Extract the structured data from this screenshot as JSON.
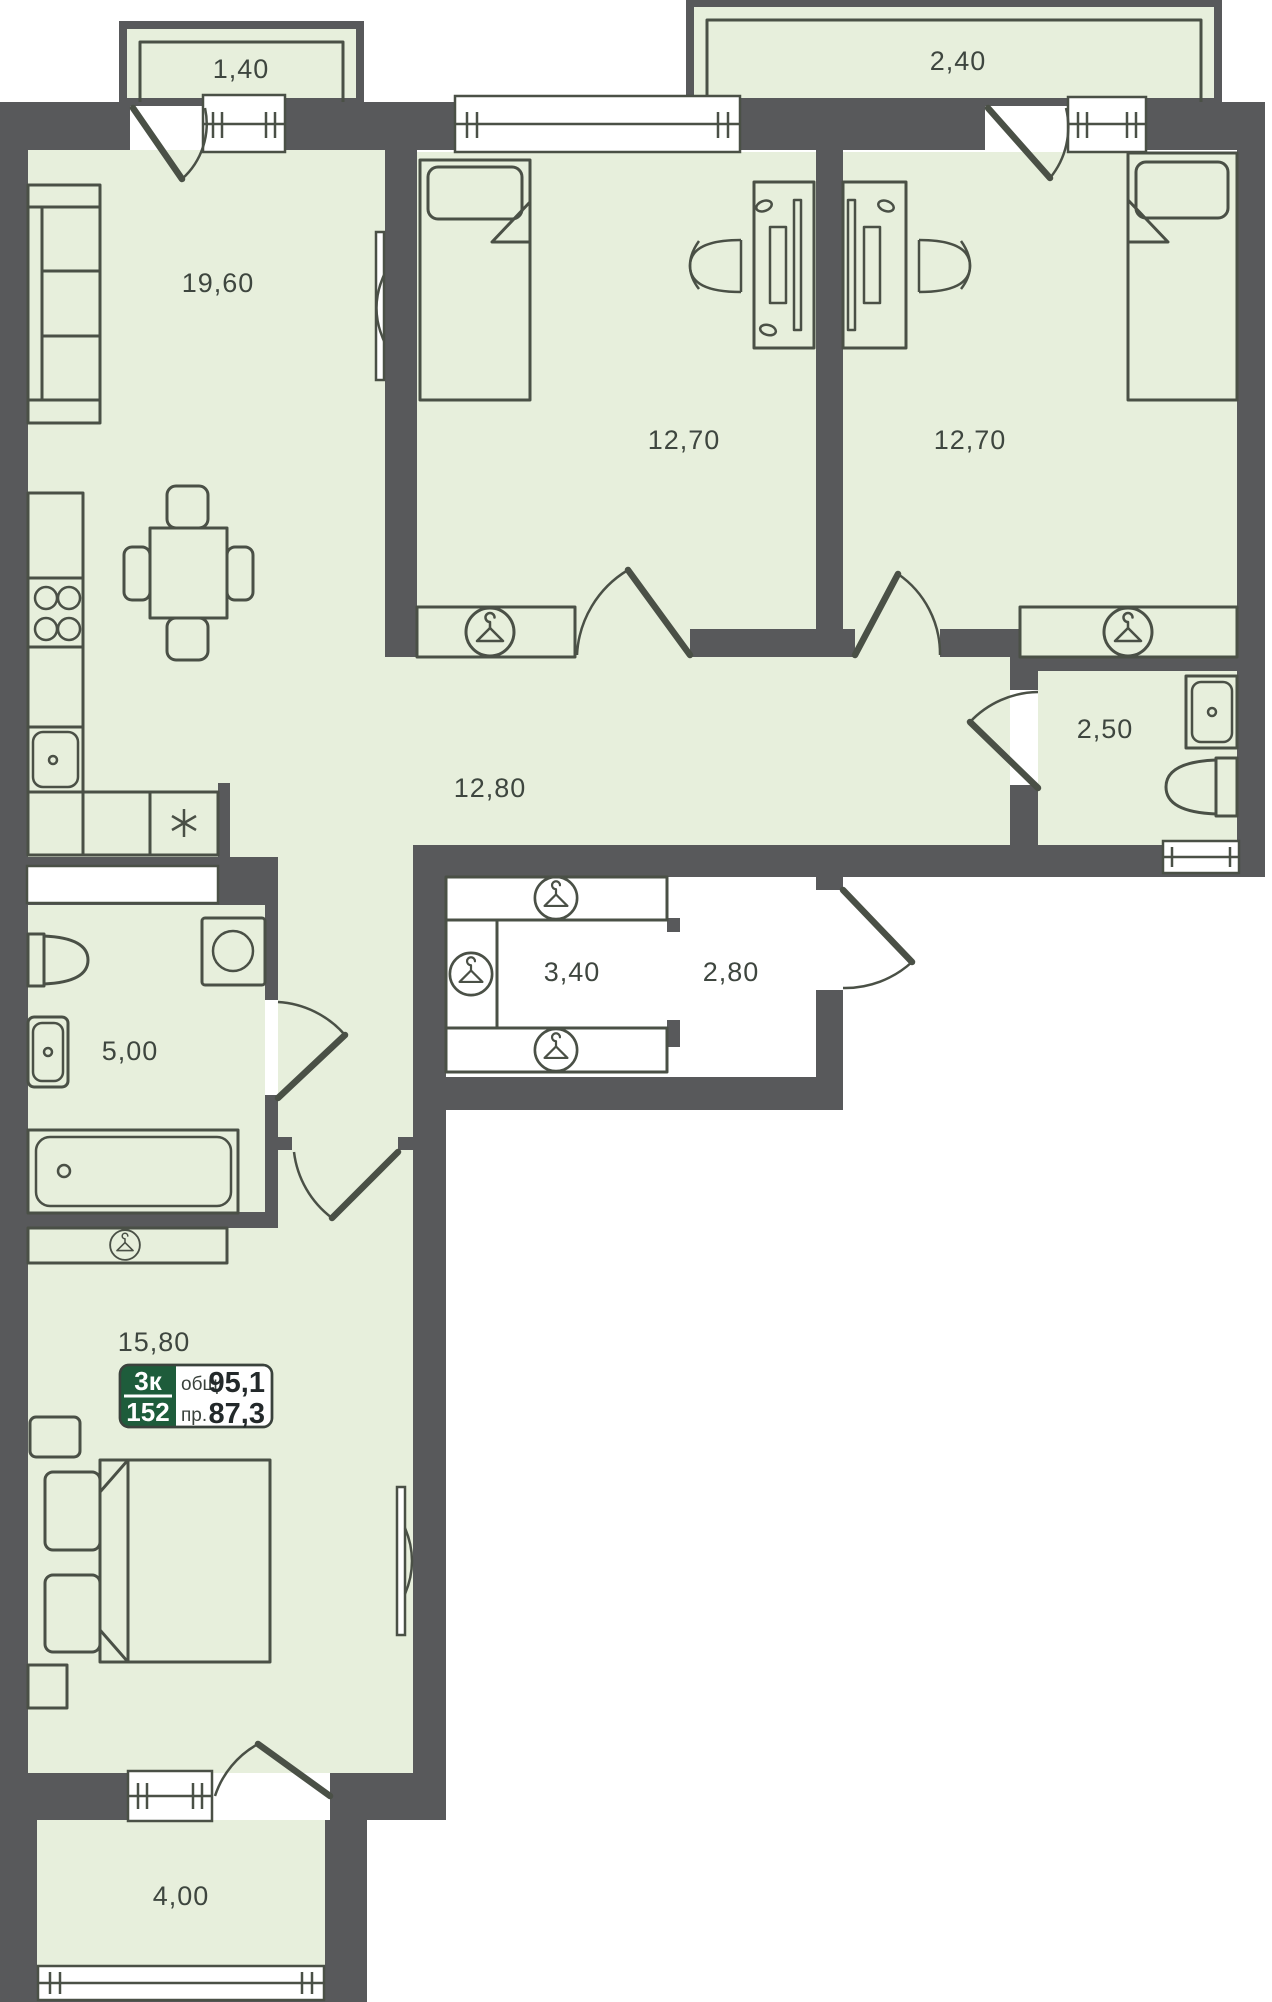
{
  "title": "Apartment floor plan",
  "badge": {
    "room_count": "3к",
    "unit_number": "152",
    "total_area_label": "общ.",
    "total_area_value": "95,1",
    "living_area_label": "пр.",
    "living_area_value": "87,3"
  },
  "rooms": [
    {
      "id": "balcony-top-left",
      "area": "1,40"
    },
    {
      "id": "balcony-top-right",
      "area": "2,40"
    },
    {
      "id": "kitchen-living",
      "area": "19,60"
    },
    {
      "id": "bedroom-1",
      "area": "12,70"
    },
    {
      "id": "bedroom-2",
      "area": "12,70"
    },
    {
      "id": "bathroom-guest",
      "area": "2,50"
    },
    {
      "id": "hallway",
      "area": "12,80"
    },
    {
      "id": "wardrobe-closet",
      "area": "3,40"
    },
    {
      "id": "entry-hall",
      "area": "2,80"
    },
    {
      "id": "bathroom-main",
      "area": "5,00"
    },
    {
      "id": "bedroom-master",
      "area": "15,80"
    },
    {
      "id": "balcony-bottom",
      "area": "4,00"
    }
  ],
  "icons": {
    "wardrobe": "hanger-icon",
    "fridge": "snowflake-icon"
  },
  "colors": {
    "wall": "#58595b",
    "room_fill": "#e7efdc",
    "furniture_line": "#4a5046",
    "label_text": "#3e463f",
    "badge_green": "#1e5c3b",
    "white": "#ffffff"
  }
}
